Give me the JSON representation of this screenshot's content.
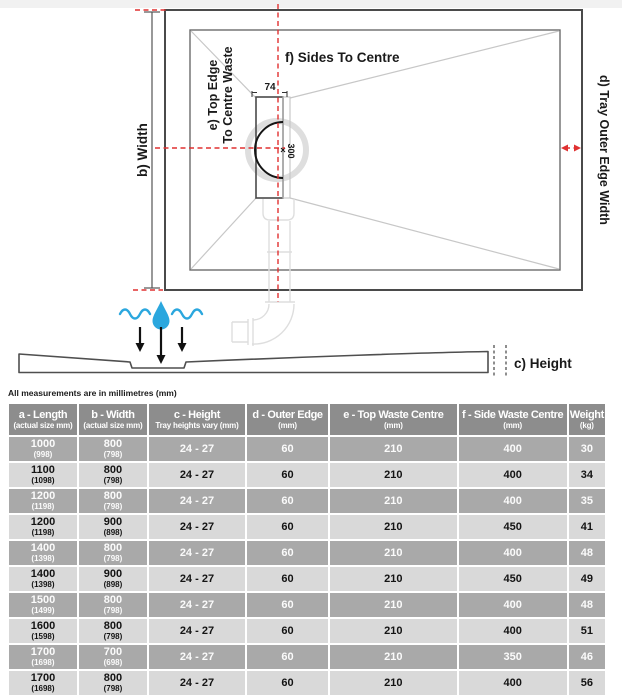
{
  "diagram": {
    "top_view": {
      "label_width": "b) Width",
      "label_top_edge_line1": "e) Top Edge",
      "label_top_edge_line2": "To Centre Waste",
      "label_sides_to_centre": "f) Sides To Centre",
      "label_outer_edge": "d) Tray Outer Edge Width",
      "dim_waste_width": "74",
      "dim_waste_length": "300"
    },
    "side_view": {
      "label_height": "c) Height"
    },
    "colors": {
      "dimension_red": "#e03131",
      "water_blue": "#2ba7de"
    }
  },
  "note": "All measurements are in millimetres (mm)",
  "table": {
    "columns": [
      {
        "label": "a - Length",
        "sub": "(actual size mm)"
      },
      {
        "label": "b - Width",
        "sub": "(actual size mm)"
      },
      {
        "label": "c - Height",
        "sub": "Tray heights vary (mm)"
      },
      {
        "label": "d - Outer Edge",
        "sub": "(mm)"
      },
      {
        "label": "e - Top Waste Centre",
        "sub": "(mm)"
      },
      {
        "label": "f - Side Waste Centre",
        "sub": "(mm)"
      },
      {
        "label": "Weight",
        "sub": "(kg)"
      }
    ],
    "rows": [
      {
        "length": "1000",
        "length_actual": "(998)",
        "width": "800",
        "width_actual": "(798)",
        "height": "24 - 27",
        "outer_edge": "60",
        "top_waste": "210",
        "side_waste": "400",
        "weight": "30"
      },
      {
        "length": "1100",
        "length_actual": "(1098)",
        "width": "800",
        "width_actual": "(798)",
        "height": "24 - 27",
        "outer_edge": "60",
        "top_waste": "210",
        "side_waste": "400",
        "weight": "34"
      },
      {
        "length": "1200",
        "length_actual": "(1198)",
        "width": "800",
        "width_actual": "(798)",
        "height": "24 - 27",
        "outer_edge": "60",
        "top_waste": "210",
        "side_waste": "400",
        "weight": "35"
      },
      {
        "length": "1200",
        "length_actual": "(1198)",
        "width": "900",
        "width_actual": "(898)",
        "height": "24 - 27",
        "outer_edge": "60",
        "top_waste": "210",
        "side_waste": "450",
        "weight": "41"
      },
      {
        "length": "1400",
        "length_actual": "(1398)",
        "width": "800",
        "width_actual": "(798)",
        "height": "24 - 27",
        "outer_edge": "60",
        "top_waste": "210",
        "side_waste": "400",
        "weight": "48"
      },
      {
        "length": "1400",
        "length_actual": "(1398)",
        "width": "900",
        "width_actual": "(898)",
        "height": "24 - 27",
        "outer_edge": "60",
        "top_waste": "210",
        "side_waste": "450",
        "weight": "49"
      },
      {
        "length": "1500",
        "length_actual": "(1499)",
        "width": "800",
        "width_actual": "(798)",
        "height": "24 - 27",
        "outer_edge": "60",
        "top_waste": "210",
        "side_waste": "400",
        "weight": "48"
      },
      {
        "length": "1600",
        "length_actual": "(1598)",
        "width": "800",
        "width_actual": "(798)",
        "height": "24 - 27",
        "outer_edge": "60",
        "top_waste": "210",
        "side_waste": "400",
        "weight": "51"
      },
      {
        "length": "1700",
        "length_actual": "(1698)",
        "width": "700",
        "width_actual": "(698)",
        "height": "24 - 27",
        "outer_edge": "60",
        "top_waste": "210",
        "side_waste": "350",
        "weight": "46"
      },
      {
        "length": "1700",
        "length_actual": "(1698)",
        "width": "800",
        "width_actual": "(798)",
        "height": "24 - 27",
        "outer_edge": "60",
        "top_waste": "210",
        "side_waste": "400",
        "weight": "56"
      }
    ]
  }
}
